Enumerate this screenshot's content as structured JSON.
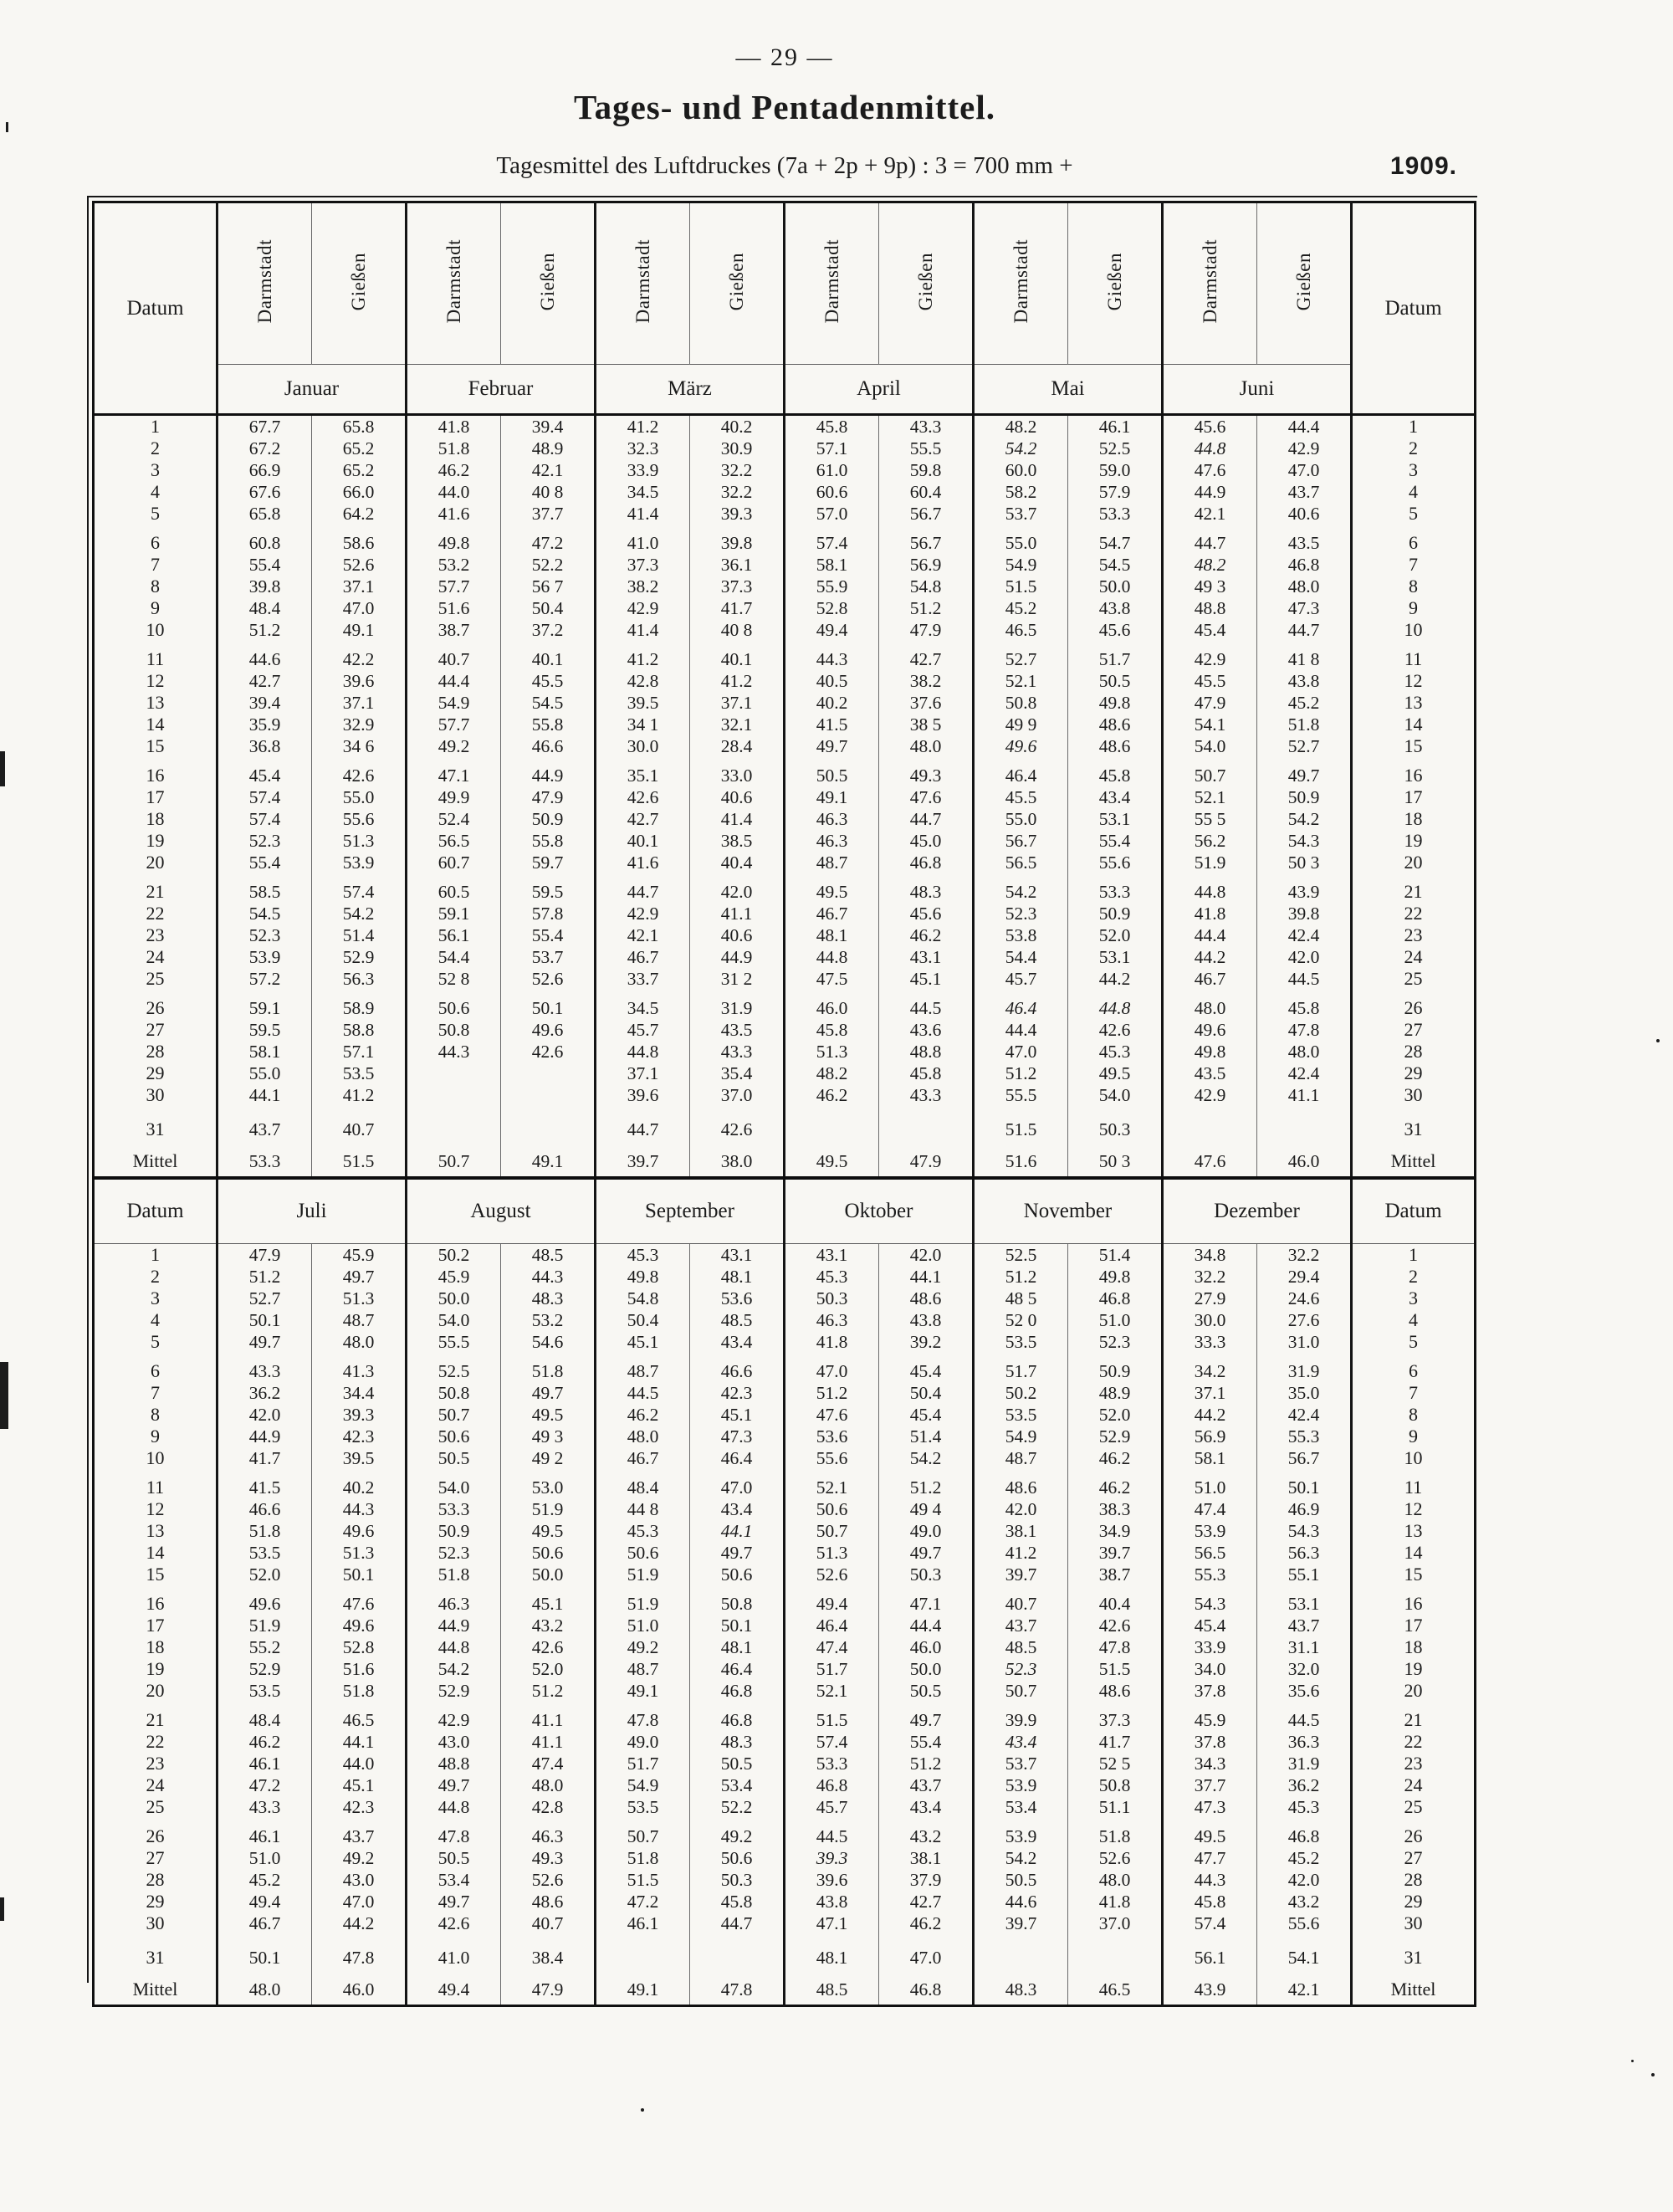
{
  "page": {
    "page_number": "— 29 —",
    "title": "Tages- und Pentadenmittel.",
    "subtitle": "Tagesmittel des Luftdruckes (7a + 2p + 9p) : 3 = 700 mm +",
    "year": "1909."
  },
  "table": {
    "datum_label": "Datum",
    "station_labels": [
      "Darmstadt",
      "Gießen"
    ],
    "months_top": [
      "Januar",
      "Februar",
      "März",
      "April",
      "Mai",
      "Juni"
    ],
    "months_bottom": [
      "Juli",
      "August",
      "September",
      "Oktober",
      "November",
      "Dezember"
    ],
    "note": "values prefixed with * are printed in italics; a space instead of a dot reproduces a faint/missing decimal point in the print",
    "rows_top": [
      {
        "day": "1",
        "values": [
          "67.7",
          "65.8",
          "41.8",
          "39.4",
          "41.2",
          "40.2",
          "45.8",
          "43.3",
          "48.2",
          "46.1",
          "45.6",
          "44.4"
        ]
      },
      {
        "day": "2",
        "values": [
          "67.2",
          "65.2",
          "51.8",
          "48.9",
          "32.3",
          "30.9",
          "57.1",
          "55.5",
          "*54.2",
          "52.5",
          "*44.8",
          "42.9"
        ]
      },
      {
        "day": "3",
        "values": [
          "66.9",
          "65.2",
          "46.2",
          "42.1",
          "33.9",
          "32.2",
          "61.0",
          "59.8",
          "60.0",
          "59.0",
          "47.6",
          "47.0"
        ]
      },
      {
        "day": "4",
        "values": [
          "67.6",
          "66.0",
          "44.0",
          "40 8",
          "34.5",
          "32.2",
          "60.6",
          "60.4",
          "58.2",
          "57.9",
          "44.9",
          "43.7"
        ]
      },
      {
        "day": "5",
        "values": [
          "65.8",
          "64.2",
          "41.6",
          "37.7",
          "41.4",
          "39.3",
          "57.0",
          "56.7",
          "53.7",
          "53.3",
          "42.1",
          "40.6"
        ]
      },
      {
        "day": "6",
        "values": [
          "60.8",
          "58.6",
          "49.8",
          "47.2",
          "41.0",
          "39.8",
          "57.4",
          "56.7",
          "55.0",
          "54.7",
          "44.7",
          "43.5"
        ]
      },
      {
        "day": "7",
        "values": [
          "55.4",
          "52.6",
          "53.2",
          "52.2",
          "37.3",
          "36.1",
          "58.1",
          "56.9",
          "54.9",
          "54.5",
          "*48.2",
          "46.8"
        ]
      },
      {
        "day": "8",
        "values": [
          "39.8",
          "37.1",
          "57.7",
          "56 7",
          "38.2",
          "37.3",
          "55.9",
          "54.8",
          "51.5",
          "50.0",
          "49 3",
          "48.0"
        ]
      },
      {
        "day": "9",
        "values": [
          "48.4",
          "47.0",
          "51.6",
          "50.4",
          "42.9",
          "41.7",
          "52.8",
          "51.2",
          "45.2",
          "43.8",
          "48.8",
          "47.3"
        ]
      },
      {
        "day": "10",
        "values": [
          "51.2",
          "49.1",
          "38.7",
          "37.2",
          "41.4",
          "40 8",
          "49.4",
          "47.9",
          "46.5",
          "45.6",
          "45.4",
          "44.7"
        ]
      },
      {
        "day": "11",
        "values": [
          "44.6",
          "42.2",
          "40.7",
          "40.1",
          "41.2",
          "40.1",
          "44.3",
          "42.7",
          "52.7",
          "51.7",
          "42.9",
          "41 8"
        ]
      },
      {
        "day": "12",
        "values": [
          "42.7",
          "39.6",
          "44.4",
          "45.5",
          "42.8",
          "41.2",
          "40.5",
          "38.2",
          "52.1",
          "50.5",
          "45.5",
          "43.8"
        ]
      },
      {
        "day": "13",
        "values": [
          "39.4",
          "37.1",
          "54.9",
          "54.5",
          "39.5",
          "37.1",
          "40.2",
          "37.6",
          "50.8",
          "49.8",
          "47.9",
          "45.2"
        ]
      },
      {
        "day": "14",
        "values": [
          "35.9",
          "32.9",
          "57.7",
          "55.8",
          "34 1",
          "32.1",
          "41.5",
          "38 5",
          "49 9",
          "48.6",
          "54.1",
          "51.8"
        ]
      },
      {
        "day": "15",
        "values": [
          "36.8",
          "34 6",
          "49.2",
          "46.6",
          "30.0",
          "28.4",
          "49.7",
          "48.0",
          "*49.6",
          "48.6",
          "54.0",
          "52.7"
        ]
      },
      {
        "day": "16",
        "values": [
          "45.4",
          "42.6",
          "47.1",
          "44.9",
          "35.1",
          "33.0",
          "50.5",
          "49.3",
          "46.4",
          "45.8",
          "50.7",
          "49.7"
        ]
      },
      {
        "day": "17",
        "values": [
          "57.4",
          "55.0",
          "49.9",
          "47.9",
          "42.6",
          "40.6",
          "49.1",
          "47.6",
          "45.5",
          "43.4",
          "52.1",
          "50.9"
        ]
      },
      {
        "day": "18",
        "values": [
          "57.4",
          "55.6",
          "52.4",
          "50.9",
          "42.7",
          "41.4",
          "46.3",
          "44.7",
          "55.0",
          "53.1",
          "55 5",
          "54.2"
        ]
      },
      {
        "day": "19",
        "values": [
          "52.3",
          "51.3",
          "56.5",
          "55.8",
          "40.1",
          "38.5",
          "46.3",
          "45.0",
          "56.7",
          "55.4",
          "56.2",
          "54.3"
        ]
      },
      {
        "day": "20",
        "values": [
          "55.4",
          "53.9",
          "60.7",
          "59.7",
          "41.6",
          "40.4",
          "48.7",
          "46.8",
          "56.5",
          "55.6",
          "51.9",
          "50 3"
        ]
      },
      {
        "day": "21",
        "values": [
          "58.5",
          "57.4",
          "60.5",
          "59.5",
          "44.7",
          "42.0",
          "49.5",
          "48.3",
          "54.2",
          "53.3",
          "44.8",
          "43.9"
        ]
      },
      {
        "day": "22",
        "values": [
          "54.5",
          "54.2",
          "59.1",
          "57.8",
          "42.9",
          "41.1",
          "46.7",
          "45.6",
          "52.3",
          "50.9",
          "41.8",
          "39.8"
        ]
      },
      {
        "day": "23",
        "values": [
          "52.3",
          "51.4",
          "56.1",
          "55.4",
          "42.1",
          "40.6",
          "48.1",
          "46.2",
          "53.8",
          "52.0",
          "44.4",
          "42.4"
        ]
      },
      {
        "day": "24",
        "values": [
          "53.9",
          "52.9",
          "54.4",
          "53.7",
          "46.7",
          "44.9",
          "44.8",
          "43.1",
          "54.4",
          "53.1",
          "44.2",
          "42.0"
        ]
      },
      {
        "day": "25",
        "values": [
          "57.2",
          "56.3",
          "52 8",
          "52.6",
          "33.7",
          "31 2",
          "47.5",
          "45.1",
          "45.7",
          "44.2",
          "46.7",
          "44.5"
        ]
      },
      {
        "day": "26",
        "values": [
          "59.1",
          "58.9",
          "50.6",
          "50.1",
          "34.5",
          "31.9",
          "46.0",
          "44.5",
          "*46.4",
          "*44.8",
          "48.0",
          "45.8"
        ]
      },
      {
        "day": "27",
        "values": [
          "59.5",
          "58.8",
          "50.8",
          "49.6",
          "45.7",
          "43.5",
          "45.8",
          "43.6",
          "44.4",
          "42.6",
          "49.6",
          "47.8"
        ]
      },
      {
        "day": "28",
        "values": [
          "58.1",
          "57.1",
          "44.3",
          "42.6",
          "44.8",
          "43.3",
          "51.3",
          "48.8",
          "47.0",
          "45.3",
          "49.8",
          "48.0"
        ]
      },
      {
        "day": "29",
        "values": [
          "55.0",
          "53.5",
          "",
          "",
          "37.1",
          "35.4",
          "48.2",
          "45.8",
          "51.2",
          "49.5",
          "43.5",
          "42.4"
        ]
      },
      {
        "day": "30",
        "values": [
          "44.1",
          "41.2",
          "",
          "",
          "39.6",
          "37.0",
          "46.2",
          "43.3",
          "55.5",
          "54.0",
          "42.9",
          "41.1"
        ]
      },
      {
        "day": "31",
        "values": [
          "43.7",
          "40.7",
          "",
          "",
          "44.7",
          "42.6",
          "",
          "",
          "51.5",
          "50.3",
          "",
          ""
        ]
      },
      {
        "day": "Mittel",
        "values": [
          "53.3",
          "51.5",
          "50.7",
          "49.1",
          "39.7",
          "38.0",
          "49.5",
          "47.9",
          "51.6",
          "50 3",
          "47.6",
          "46.0"
        ]
      }
    ],
    "rows_bottom": [
      {
        "day": "1",
        "values": [
          "47.9",
          "45.9",
          "50.2",
          "48.5",
          "45.3",
          "43.1",
          "43.1",
          "42.0",
          "52.5",
          "51.4",
          "34.8",
          "32.2"
        ]
      },
      {
        "day": "2",
        "values": [
          "51.2",
          "49.7",
          "45.9",
          "44.3",
          "49.8",
          "48.1",
          "45.3",
          "44.1",
          "51.2",
          "49.8",
          "32.2",
          "29.4"
        ]
      },
      {
        "day": "3",
        "values": [
          "52.7",
          "51.3",
          "50.0",
          "48.3",
          "54.8",
          "53.6",
          "50.3",
          "48.6",
          "48 5",
          "46.8",
          "27.9",
          "24.6"
        ]
      },
      {
        "day": "4",
        "values": [
          "50.1",
          "48.7",
          "54.0",
          "53.2",
          "50.4",
          "48.5",
          "46.3",
          "43.8",
          "52 0",
          "51.0",
          "30.0",
          "27.6"
        ]
      },
      {
        "day": "5",
        "values": [
          "49.7",
          "48.0",
          "55.5",
          "54.6",
          "45.1",
          "43.4",
          "41.8",
          "39.2",
          "53.5",
          "52.3",
          "33.3",
          "31.0"
        ]
      },
      {
        "day": "6",
        "values": [
          "43.3",
          "41.3",
          "52.5",
          "51.8",
          "48.7",
          "46.6",
          "47.0",
          "45.4",
          "51.7",
          "50.9",
          "34.2",
          "31.9"
        ]
      },
      {
        "day": "7",
        "values": [
          "36.2",
          "34.4",
          "50.8",
          "49.7",
          "44.5",
          "42.3",
          "51.2",
          "50.4",
          "50.2",
          "48.9",
          "37.1",
          "35.0"
        ]
      },
      {
        "day": "8",
        "values": [
          "42.0",
          "39.3",
          "50.7",
          "49.5",
          "46.2",
          "45.1",
          "47.6",
          "45.4",
          "53.5",
          "52.0",
          "44.2",
          "42.4"
        ]
      },
      {
        "day": "9",
        "values": [
          "44.9",
          "42.3",
          "50.6",
          "49 3",
          "48.0",
          "47.3",
          "53.6",
          "51.4",
          "54.9",
          "52.9",
          "56.9",
          "55.3"
        ]
      },
      {
        "day": "10",
        "values": [
          "41.7",
          "39.5",
          "50.5",
          "49 2",
          "46.7",
          "46.4",
          "55.6",
          "54.2",
          "48.7",
          "46.2",
          "58.1",
          "56.7"
        ]
      },
      {
        "day": "11",
        "values": [
          "41.5",
          "40.2",
          "54.0",
          "53.0",
          "48.4",
          "47.0",
          "52.1",
          "51.2",
          "48.6",
          "46.2",
          "51.0",
          "50.1"
        ]
      },
      {
        "day": "12",
        "values": [
          "46.6",
          "44.3",
          "53.3",
          "51.9",
          "44 8",
          "43.4",
          "50.6",
          "49 4",
          "42.0",
          "38.3",
          "47.4",
          "46.9"
        ]
      },
      {
        "day": "13",
        "values": [
          "51.8",
          "49.6",
          "50.9",
          "49.5",
          "45.3",
          "*44.1",
          "50.7",
          "49.0",
          "38.1",
          "34.9",
          "53.9",
          "54.3"
        ]
      },
      {
        "day": "14",
        "values": [
          "53.5",
          "51.3",
          "52.3",
          "50.6",
          "50.6",
          "49.7",
          "51.3",
          "49.7",
          "41.2",
          "39.7",
          "56.5",
          "56.3"
        ]
      },
      {
        "day": "15",
        "values": [
          "52.0",
          "50.1",
          "51.8",
          "50.0",
          "51.9",
          "50.6",
          "52.6",
          "50.3",
          "39.7",
          "38.7",
          "55.3",
          "55.1"
        ]
      },
      {
        "day": "16",
        "values": [
          "49.6",
          "47.6",
          "46.3",
          "45.1",
          "51.9",
          "50.8",
          "49.4",
          "47.1",
          "40.7",
          "40.4",
          "54.3",
          "53.1"
        ]
      },
      {
        "day": "17",
        "values": [
          "51.9",
          "49.6",
          "44.9",
          "43.2",
          "51.0",
          "50.1",
          "46.4",
          "44.4",
          "43.7",
          "42.6",
          "45.4",
          "43.7"
        ]
      },
      {
        "day": "18",
        "values": [
          "55.2",
          "52.8",
          "44.8",
          "42.6",
          "49.2",
          "48.1",
          "47.4",
          "46.0",
          "48.5",
          "47.8",
          "33.9",
          "31.1"
        ]
      },
      {
        "day": "19",
        "values": [
          "52.9",
          "51.6",
          "54.2",
          "52.0",
          "48.7",
          "46.4",
          "51.7",
          "50.0",
          "*52.3",
          "51.5",
          "34.0",
          "32.0"
        ]
      },
      {
        "day": "20",
        "values": [
          "53.5",
          "51.8",
          "52.9",
          "51.2",
          "49.1",
          "46.8",
          "52.1",
          "50.5",
          "50.7",
          "48.6",
          "37.8",
          "35.6"
        ]
      },
      {
        "day": "21",
        "values": [
          "48.4",
          "46.5",
          "42.9",
          "41.1",
          "47.8",
          "46.8",
          "51.5",
          "49.7",
          "39.9",
          "37.3",
          "45.9",
          "44.5"
        ]
      },
      {
        "day": "22",
        "values": [
          "46.2",
          "44.1",
          "43.0",
          "41.1",
          "49.0",
          "48.3",
          "57.4",
          "55.4",
          "*43.4",
          "41.7",
          "37.8",
          "36.3"
        ]
      },
      {
        "day": "23",
        "values": [
          "46.1",
          "44.0",
          "48.8",
          "47.4",
          "51.7",
          "50.5",
          "53.3",
          "51.2",
          "53.7",
          "52 5",
          "34.3",
          "31.9"
        ]
      },
      {
        "day": "24",
        "values": [
          "47.2",
          "45.1",
          "49.7",
          "48.0",
          "54.9",
          "53.4",
          "46.8",
          "43.7",
          "53.9",
          "50.8",
          "37.7",
          "36.2"
        ]
      },
      {
        "day": "25",
        "values": [
          "43.3",
          "42.3",
          "44.8",
          "42.8",
          "53.5",
          "52.2",
          "45.7",
          "43.4",
          "53.4",
          "51.1",
          "47.3",
          "45.3"
        ]
      },
      {
        "day": "26",
        "values": [
          "46.1",
          "43.7",
          "47.8",
          "46.3",
          "50.7",
          "49.2",
          "44.5",
          "43.2",
          "53.9",
          "51.8",
          "49.5",
          "46.8"
        ]
      },
      {
        "day": "27",
        "values": [
          "51.0",
          "49.2",
          "50.5",
          "49.3",
          "51.8",
          "50.6",
          "*39.3",
          "38.1",
          "54.2",
          "52.6",
          "47.7",
          "45.2"
        ]
      },
      {
        "day": "28",
        "values": [
          "45.2",
          "43.0",
          "53.4",
          "52.6",
          "51.5",
          "50.3",
          "39.6",
          "37.9",
          "50.5",
          "48.0",
          "44.3",
          "42.0"
        ]
      },
      {
        "day": "29",
        "values": [
          "49.4",
          "47.0",
          "49.7",
          "48.6",
          "47.2",
          "45.8",
          "43.8",
          "42.7",
          "44.6",
          "41.8",
          "45.8",
          "43.2"
        ]
      },
      {
        "day": "30",
        "values": [
          "46.7",
          "44.2",
          "42.6",
          "40.7",
          "46.1",
          "44.7",
          "47.1",
          "46.2",
          "39.7",
          "37.0",
          "57.4",
          "55.6"
        ]
      },
      {
        "day": "31",
        "values": [
          "50.1",
          "47.8",
          "41.0",
          "38.4",
          "",
          "",
          "48.1",
          "47.0",
          "",
          "",
          "56.1",
          "54.1"
        ]
      },
      {
        "day": "Mittel",
        "values": [
          "48.0",
          "46.0",
          "49.4",
          "47.9",
          "49.1",
          "47.8",
          "48.5",
          "46.8",
          "48.3",
          "46.5",
          "43.9",
          "42.1"
        ]
      }
    ]
  }
}
